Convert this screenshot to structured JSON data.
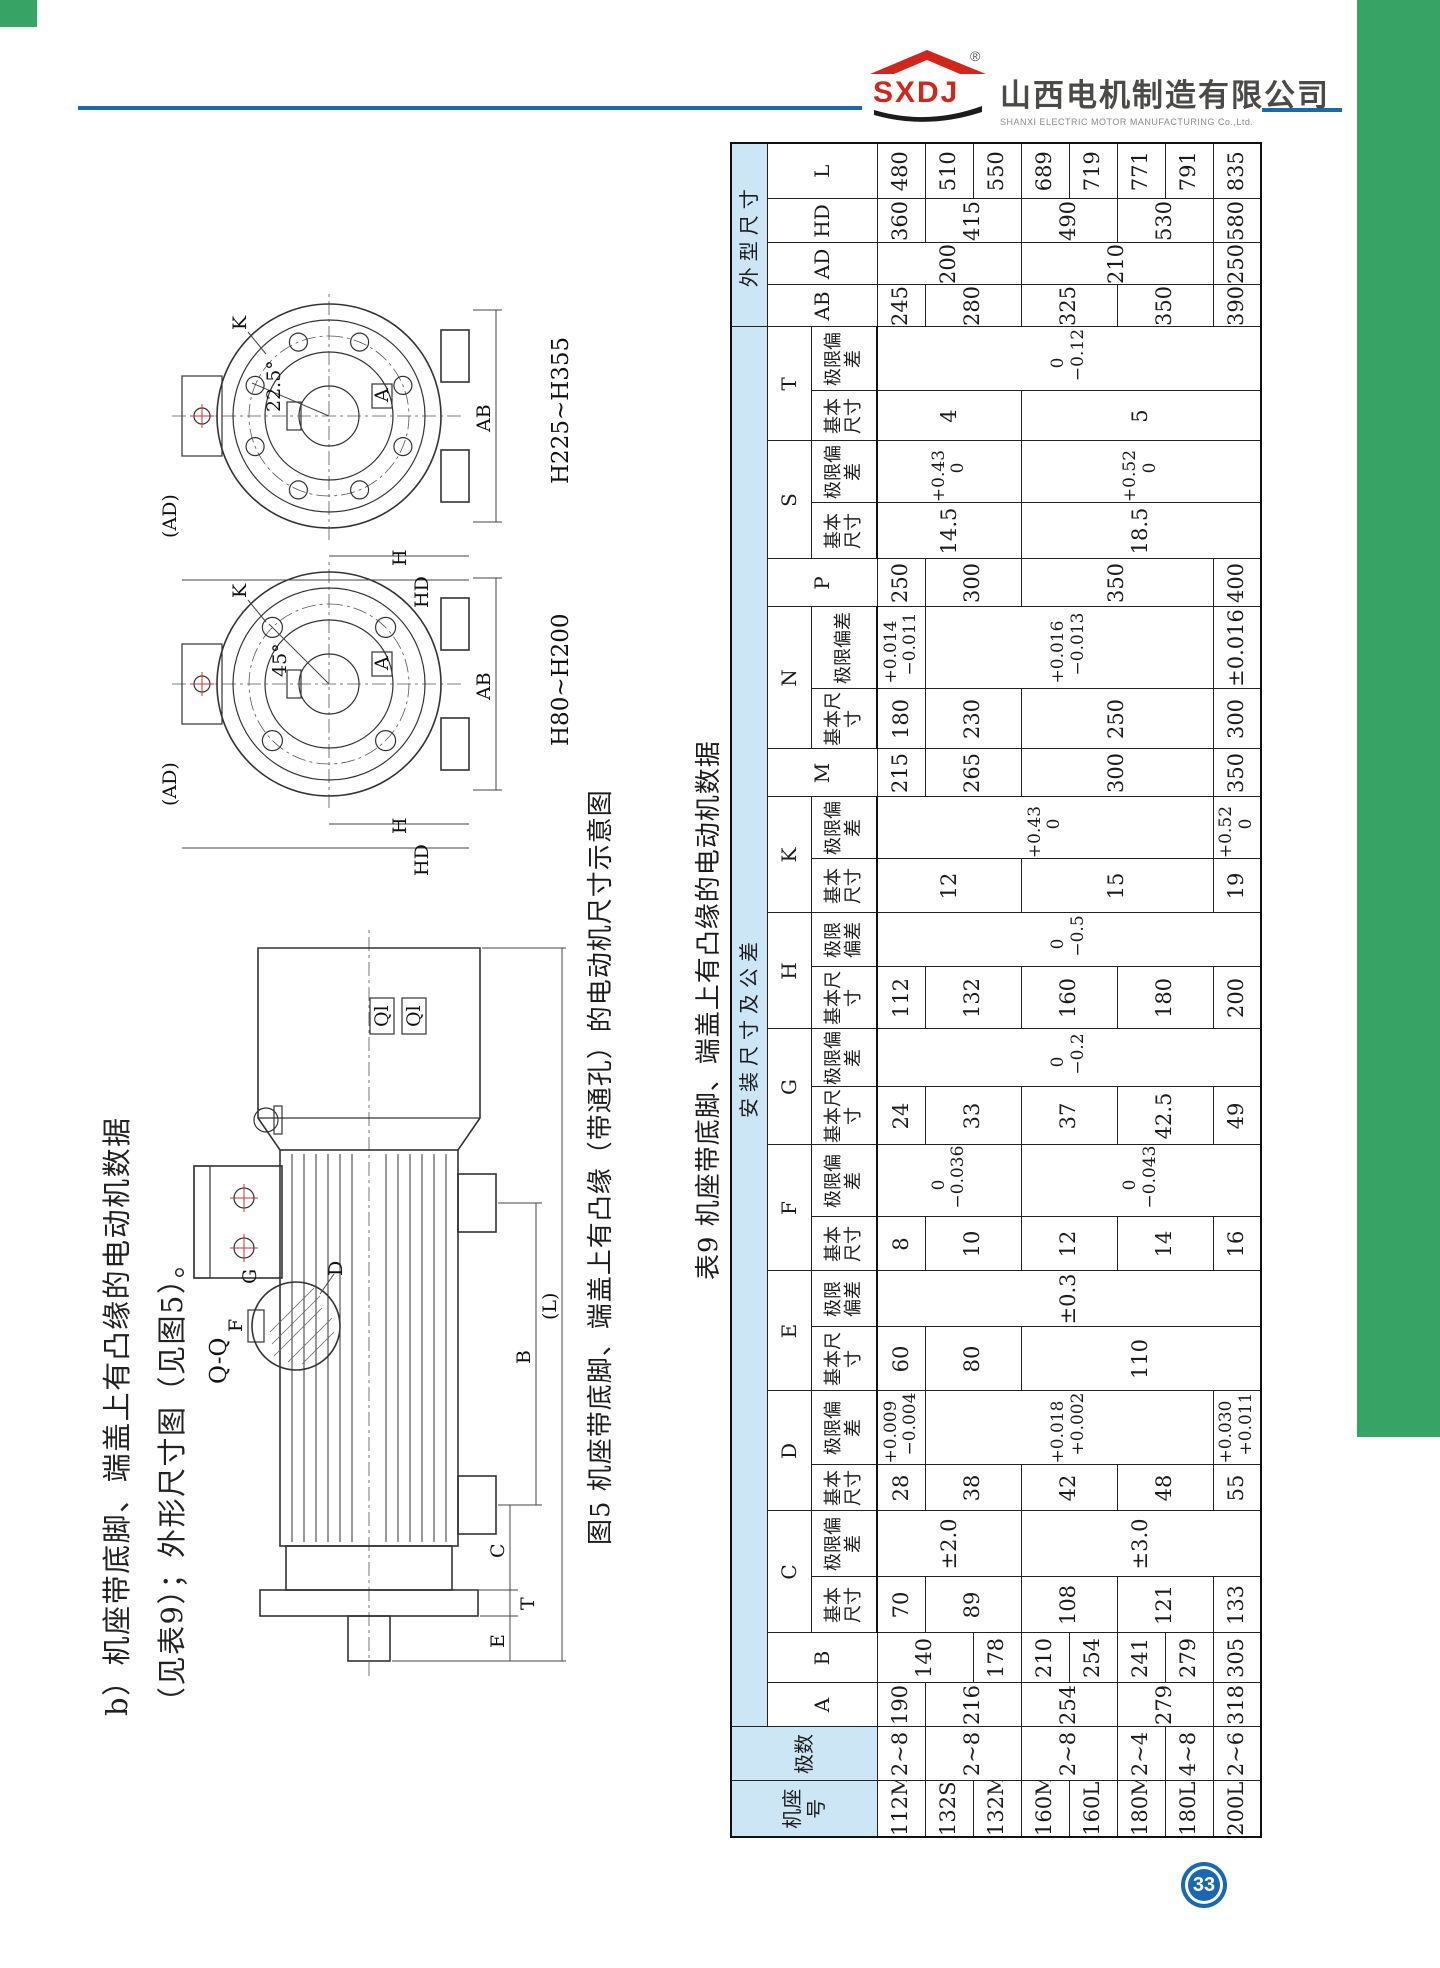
{
  "colors": {
    "green": "#37A364",
    "blue_line": "#1A6AAE",
    "logo_red": "#D0261C",
    "table_header_blue": "#CDE6F5",
    "pageno_blue": "#1A67B2"
  },
  "page": {
    "number": "33"
  },
  "header": {
    "logo_text": "SXDJ",
    "logo_reg": "®",
    "company_cn": "山西电机制造有限公司",
    "company_en": "SHANXI  ELECTRIC  MOTOR  MANUFACTURING  Co.,Ltd."
  },
  "heading": {
    "text": "b）机座带底脚、端盖上有凸缘的电动机数据（见表9）；外形尺寸图（见图5）。"
  },
  "figure": {
    "caption": "图5 机座带底脚、端盖上有凸缘（带通孔）的电动机尺寸示意图",
    "view_small_range": "H80~H200",
    "view_large_range": "H225~H355",
    "labels": {
      "ad": "(AD)",
      "hd": "HD",
      "h": "H",
      "a": "A",
      "ab": "AB",
      "k": "K",
      "angle_small": "45°",
      "angle_large": "22.5°",
      "b": "B",
      "c": "C",
      "e": "E",
      "t": "T",
      "l": "(L)",
      "d": "D",
      "f": "F",
      "g": "G",
      "qq": "Q-Q",
      "ql": "Ql"
    }
  },
  "table": {
    "title": "表9 机座带底脚、端盖上有凸缘的电动机数据",
    "headers": {
      "frame": "机座号",
      "poles": "极数",
      "group_mount": "安装尺寸及公差",
      "group_overall": "外型尺寸",
      "basic": "基本尺寸",
      "deviation": "极限偏差",
      "dim_letters": [
        "A",
        "B",
        "C",
        "D",
        "E",
        "F",
        "G",
        "H",
        "K",
        "M",
        "N",
        "P",
        "S",
        "T"
      ],
      "overall_letters": [
        "AB",
        "AD",
        "HD",
        "L"
      ],
      "tolerance_letters": [
        "C",
        "D",
        "E",
        "F",
        "G",
        "H",
        "K",
        "N",
        "S",
        "T"
      ]
    },
    "rows": [
      {
        "cells": [
          "112M",
          "2~8",
          "190",
          {
            "v": "140",
            "rs": 2
          },
          "70",
          {
            "v": "±2.0",
            "rs": 3
          },
          "28",
          "+0.009\n−0.004",
          "60",
          {
            "v": "±0.3",
            "rs": 8
          },
          "8",
          {
            "v": "0\n−0.036",
            "rs": 3
          },
          "24",
          {
            "v": "0\n−0.2",
            "rs": 8
          },
          "112",
          {
            "v": "0\n−0.5",
            "rs": 8
          },
          {
            "v": "12",
            "rs": 3
          },
          {
            "v": "+0.43\n0",
            "rs": 7
          },
          "215",
          "180",
          "+0.014\n−0.011",
          "250",
          {
            "v": "14.5",
            "rs": 3
          },
          {
            "v": "+0.43\n0",
            "rs": 3
          },
          {
            "v": "4",
            "rs": 3
          },
          {
            "v": "0\n−0.12",
            "rs": 8
          },
          "245",
          {
            "v": "200",
            "rs": 3
          },
          "360",
          "480"
        ]
      },
      {
        "cells": [
          "132S",
          {
            "v": "2~8",
            "rs": 2
          },
          {
            "v": "216",
            "rs": 2
          },
          null,
          {
            "v": "89",
            "rs": 2
          },
          null,
          {
            "v": "38",
            "rs": 2
          },
          {
            "v": "+0.018\n+0.002",
            "rs": 6
          },
          {
            "v": "80",
            "rs": 2
          },
          null,
          {
            "v": "10",
            "rs": 2
          },
          null,
          {
            "v": "33",
            "rs": 2
          },
          null,
          {
            "v": "132",
            "rs": 2
          },
          null,
          null,
          null,
          {
            "v": "265",
            "rs": 2
          },
          {
            "v": "230",
            "rs": 2
          },
          {
            "v": "+0.016\n−0.013",
            "rs": 6
          },
          {
            "v": "300",
            "rs": 2
          },
          null,
          null,
          null,
          null,
          {
            "v": "280",
            "rs": 2
          },
          null,
          {
            "v": "415",
            "rs": 2
          },
          "510"
        ]
      },
      {
        "cells": [
          "132M",
          null,
          null,
          "178",
          null,
          null,
          null,
          null,
          null,
          null,
          null,
          null,
          null,
          null,
          null,
          null,
          null,
          null,
          null,
          null,
          null,
          null,
          null,
          null,
          null,
          null,
          null,
          null,
          null,
          "550"
        ]
      },
      {
        "cells": [
          "160M",
          {
            "v": "2~8",
            "rs": 2
          },
          {
            "v": "254",
            "rs": 2
          },
          "210",
          {
            "v": "108",
            "rs": 2
          },
          {
            "v": "±3.0",
            "rs": 5
          },
          {
            "v": "42",
            "rs": 2
          },
          null,
          {
            "v": "110",
            "rs": 5
          },
          null,
          {
            "v": "12",
            "rs": 2
          },
          {
            "v": "0\n−0.043",
            "rs": 5
          },
          {
            "v": "37",
            "rs": 2
          },
          null,
          {
            "v": "160",
            "rs": 2
          },
          null,
          {
            "v": "15",
            "rs": 4
          },
          null,
          {
            "v": "300",
            "rs": 4
          },
          {
            "v": "250",
            "rs": 4
          },
          null,
          {
            "v": "350",
            "rs": 4
          },
          {
            "v": "18.5",
            "rs": 5
          },
          {
            "v": "+0.52\n0",
            "rs": 5
          },
          {
            "v": "5",
            "rs": 5
          },
          null,
          {
            "v": "325",
            "rs": 2
          },
          {
            "v": "210",
            "rs": 4
          },
          {
            "v": "490",
            "rs": 2
          },
          "689"
        ]
      },
      {
        "cells": [
          "160L",
          null,
          null,
          "254",
          null,
          null,
          null,
          null,
          null,
          null,
          null,
          null,
          null,
          null,
          null,
          null,
          null,
          null,
          null,
          null,
          null,
          null,
          null,
          null,
          null,
          null,
          null,
          null,
          null,
          "719"
        ]
      },
      {
        "cells": [
          "180M",
          "2~4",
          {
            "v": "279",
            "rs": 2
          },
          "241",
          {
            "v": "121",
            "rs": 2
          },
          null,
          {
            "v": "48",
            "rs": 2
          },
          null,
          null,
          null,
          {
            "v": "14",
            "rs": 2
          },
          null,
          {
            "v": "42.5",
            "rs": 2
          },
          null,
          {
            "v": "180",
            "rs": 2
          },
          null,
          null,
          null,
          null,
          null,
          null,
          null,
          null,
          null,
          null,
          null,
          {
            "v": "350",
            "rs": 2
          },
          null,
          {
            "v": "530",
            "rs": 2
          },
          "771"
        ]
      },
      {
        "cells": [
          "180L",
          "4~8",
          null,
          "279",
          null,
          null,
          null,
          null,
          null,
          null,
          null,
          null,
          null,
          null,
          null,
          null,
          null,
          null,
          null,
          null,
          null,
          null,
          null,
          null,
          null,
          null,
          null,
          null,
          null,
          "791"
        ]
      },
      {
        "cells": [
          "200L",
          "2~6",
          "318",
          "305",
          "133",
          null,
          "55",
          "+0.030\n+0.011",
          null,
          null,
          "16",
          null,
          "49",
          null,
          "200",
          null,
          "19",
          "+0.52\n0",
          "350",
          "300",
          "±0.016",
          "400",
          null,
          null,
          null,
          null,
          "390",
          "250",
          "580",
          "835"
        ]
      }
    ]
  }
}
